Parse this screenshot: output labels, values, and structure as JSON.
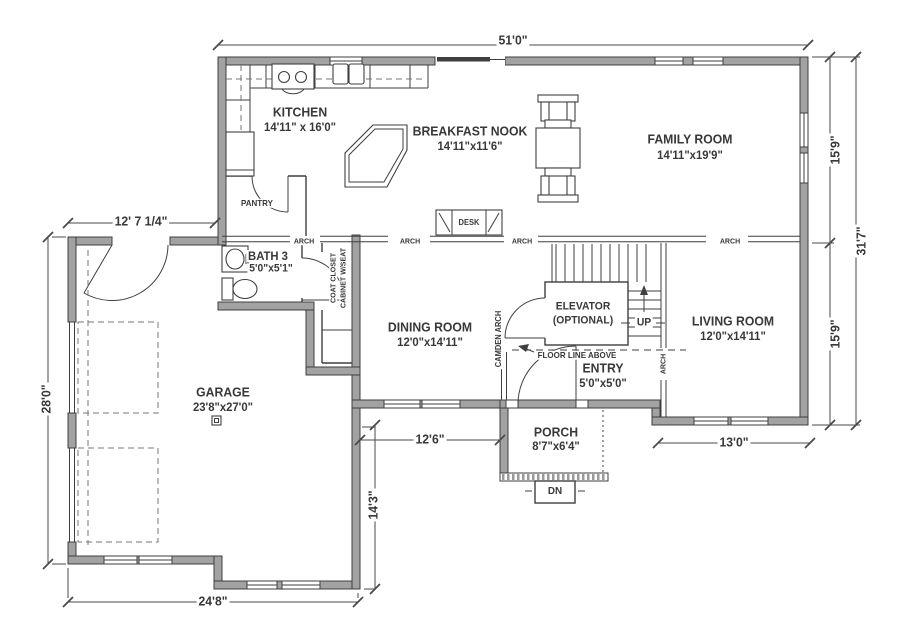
{
  "colors": {
    "wall_fill": "#a2a2a2",
    "line": "#3f3f3f",
    "dim_line": "#4a4a4a",
    "text": "#383838",
    "dash": "#777777",
    "background": "#ffffff"
  },
  "dimensions": {
    "overall_width": "51'0\"",
    "garage_offset": "12' 7 1/4\"",
    "garage_side": "28'0\"",
    "garage_bottom": "24'8\"",
    "garage_depth": "14'3\"",
    "dining_width": "12'6\"",
    "living_width": "13'0\"",
    "right_upper": "15'9\"",
    "right_lower": "15'9\"",
    "right_total": "31'7\""
  },
  "rooms": {
    "kitchen": {
      "name": "KITCHEN",
      "size": "14'11\" x 16'0\""
    },
    "breakfast_nook": {
      "name": "BREAKFAST NOOK",
      "size": "14'11\"x11'6\""
    },
    "family_room": {
      "name": "FAMILY ROOM",
      "size": "14'11\"x19'9\""
    },
    "dining_room": {
      "name": "DINING ROOM",
      "size": "12'0\"x14'11\""
    },
    "living_room": {
      "name": "LIVING ROOM",
      "size": "12'0\"x14'11\""
    },
    "garage": {
      "name": "GARAGE",
      "size": "23'8\"x27'0\""
    },
    "entry": {
      "name": "ENTRY",
      "size": "5'0\"x5'0\""
    },
    "porch": {
      "name": "PORCH",
      "size": "8'7\"x6'4\""
    },
    "bath_3": {
      "name": "BATH 3",
      "size": "5'0\"x5'1\""
    },
    "pantry": {
      "name": "PANTRY"
    },
    "elevator": {
      "name": "ELEVATOR",
      "qualifier": "(OPTIONAL)"
    }
  },
  "annotations": {
    "arch": "ARCH",
    "camden_arch": "CAMDEN ARCH",
    "coat_closet_line1": "COAT CLOSET",
    "coat_closet_line2": "CABINET W/SEAT",
    "desk": "DESK",
    "up": "UP",
    "down": "DN",
    "floor_line": "FLOOR LINE ABOVE"
  }
}
